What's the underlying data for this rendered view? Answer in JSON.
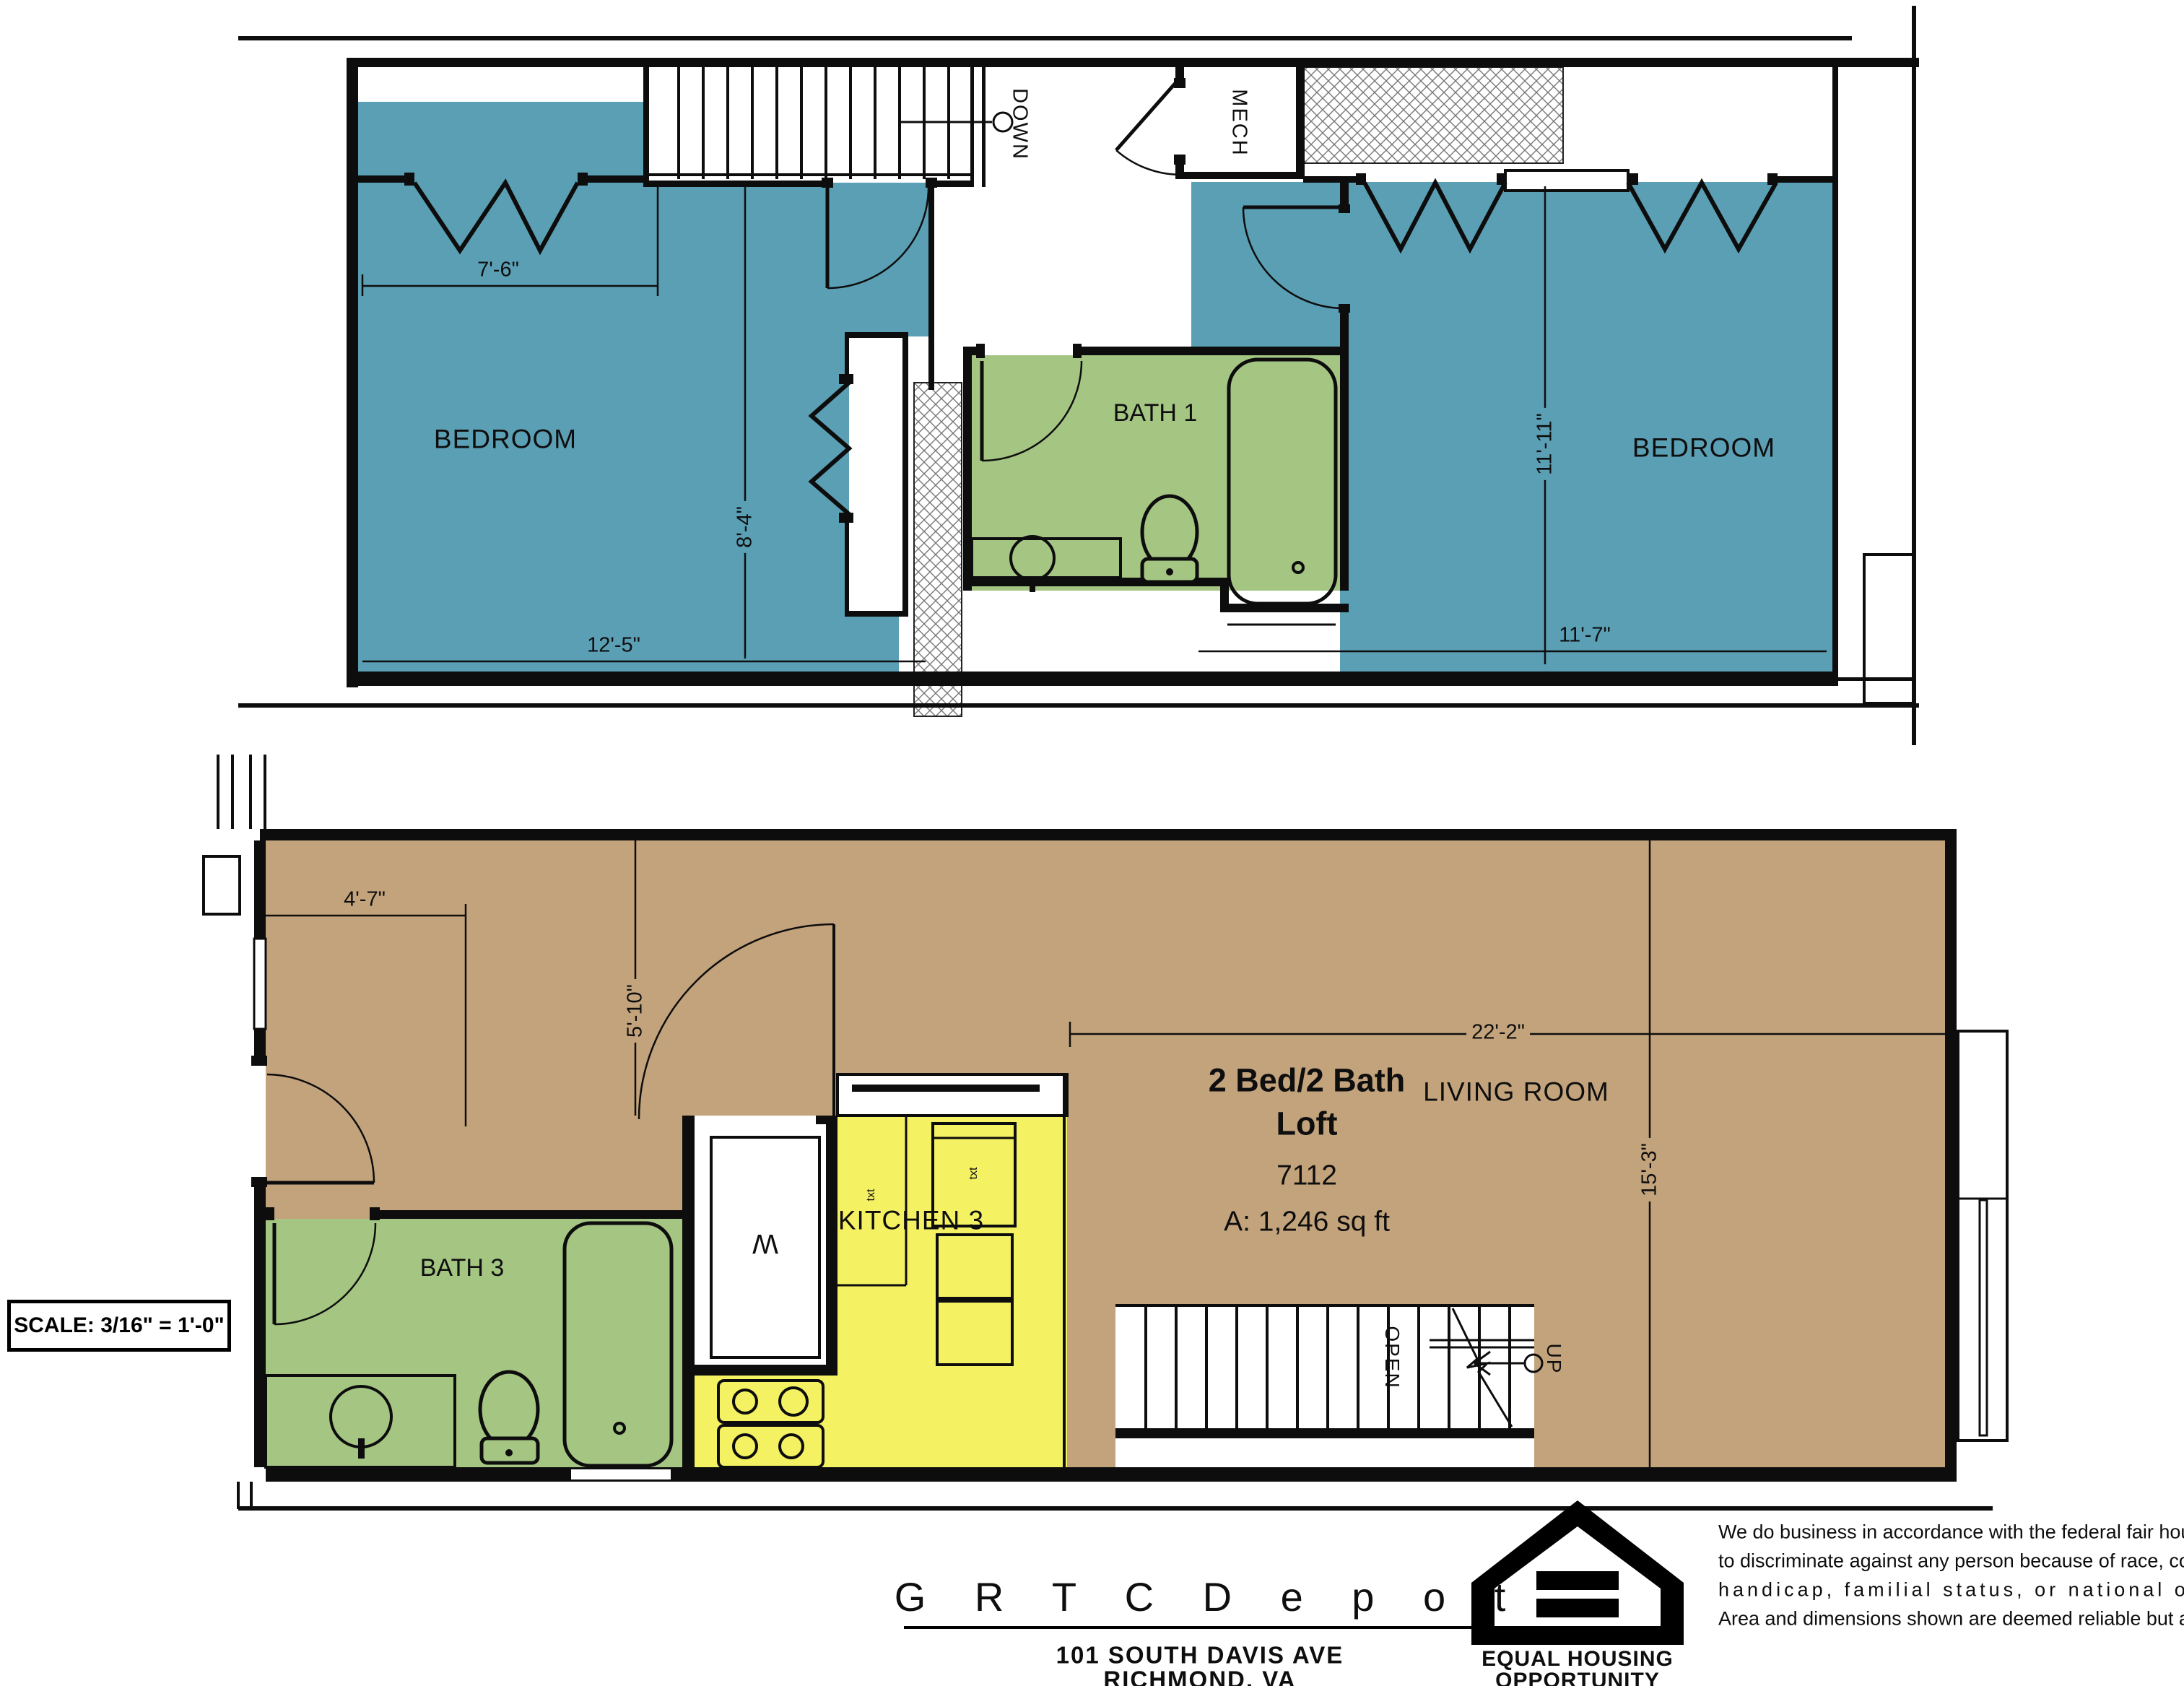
{
  "colors": {
    "room_blue": "#5B9FB5",
    "room_green": "#A5C583",
    "room_yellow": "#F4F163",
    "room_tan": "#C3A37C",
    "wall": "#0d0d0d"
  },
  "upper_floor": {
    "bedroom_left_label": "BEDROOM",
    "bedroom_right_label": "BEDROOM",
    "bath_label": "BATH 1",
    "mech_label": "MECH",
    "stairs_label": "DOWN",
    "dim_closet": "7'-6\"",
    "dim_bedroom_left_width": "12'-5\"",
    "dim_bedroom_left_height": "8'-4\"",
    "dim_bedroom_right_height": "11'-11\"",
    "dim_bedroom_right_width": "11'-7\""
  },
  "lower_floor": {
    "bath_label": "BATH 3",
    "kitchen_label": "KITCHEN 3",
    "living_label": "LIVING ROOM",
    "washer_label": "W",
    "counter_note": "txt",
    "cabinet_note": "txt",
    "stairs_open_label": "OPEN",
    "stairs_up_label": "UP",
    "dim_entry": "4'-7\"",
    "dim_laundry": "5'-10\"",
    "dim_living_width": "22'-2\"",
    "dim_living_height": "15'-3\"",
    "unit": {
      "title_line1": "2 Bed/2 Bath",
      "title_line2": "Loft",
      "unit_number": "7112",
      "area": "A: 1,246 sq ft"
    }
  },
  "scale_note": "SCALE:  3/16\" = 1'-0\"",
  "title_block": {
    "project_name": "G R T C   D e p o t",
    "address": "101 SOUTH DAVIS AVE",
    "city": "RICHMOND, VA"
  },
  "fair_housing": {
    "logo_title": "EQUAL HOUSING",
    "logo_subtitle": "OPPORTUNITY",
    "line1": "We do business in accordance with the federal fair housing law.  It is illegal",
    "line2": "to discriminate against any person because of race, color, religion, sex,",
    "line3": "handicap, familial status, or national origin.",
    "line4": "Area and dimensions shown are deemed reliable but are not guaranteed."
  }
}
